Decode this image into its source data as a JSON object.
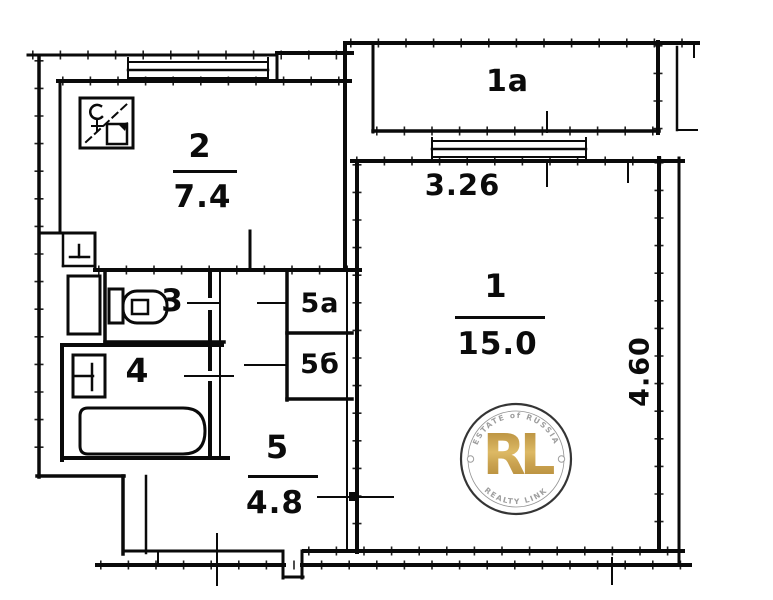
{
  "rooms": {
    "kitchen": {
      "number": "2",
      "area": "7.4"
    },
    "balcony": {
      "number": "1а"
    },
    "living": {
      "number": "1",
      "area": "15.0",
      "width_m": "3.26",
      "depth_m": "4.60"
    },
    "toilet": {
      "number": "3"
    },
    "bathroom": {
      "number": "4"
    },
    "closet_a": {
      "number": "5а"
    },
    "closet_b": {
      "number": "5б"
    },
    "hallway": {
      "number": "5",
      "area": "4.8"
    }
  },
  "watermark": {
    "top_text": "ESTATE of RUSSIA",
    "monogram": "RL",
    "bottom_text": "REALTY LINK",
    "gold_color": "#c49a3f",
    "ring_color": "#2d2d2d",
    "arc_text_color": "#9b9b9b"
  },
  "icons": {
    "stove_vent": "stove-vent-icon",
    "toilet": "toilet-icon",
    "bathtub": "bathtub-icon",
    "kitchen_sink": "kitchen-sink-icon",
    "bathroom_sink": "bathroom-sink-icon"
  },
  "colors": {
    "line": "#0a0a0a",
    "background": "#ffffff"
  }
}
